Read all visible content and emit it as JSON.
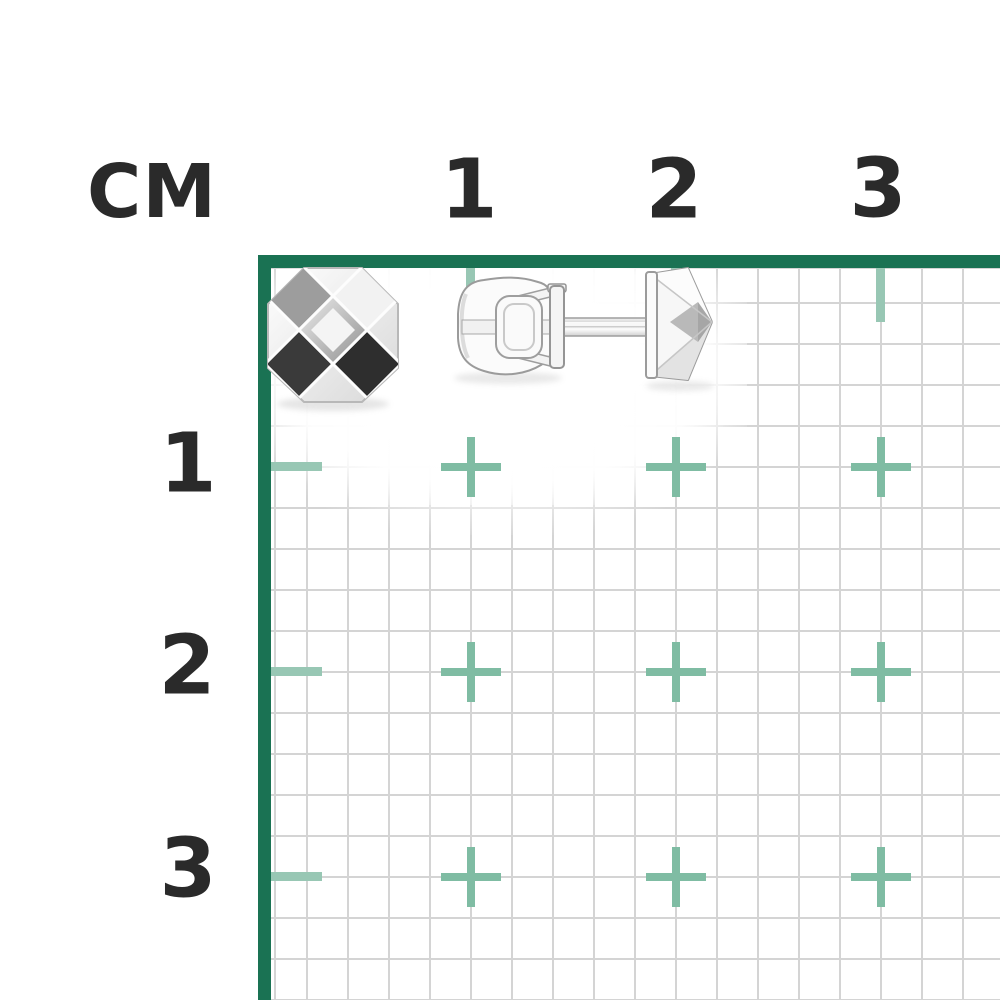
{
  "ruler": {
    "unit_label": "СМ",
    "top_labels": [
      "1",
      "2",
      "3"
    ],
    "left_labels": [
      "1",
      "2",
      "3"
    ]
  },
  "colors": {
    "background": "#FFFFFF",
    "frame_green": "#1A7253",
    "tick_green": "#98C7B4",
    "cross_green": "#7FBCA3",
    "grid_line": "#D4D4D4",
    "label_text": "#2A2A2A",
    "metal_light": "#F5F5F5",
    "metal_gray": "#9D9D9D",
    "metal_dark": "#2F2F2F"
  },
  "photo": {
    "items": [
      {
        "name": "stud-earring-front-view"
      },
      {
        "name": "stud-earring-side-view-with-screw-back"
      }
    ]
  }
}
